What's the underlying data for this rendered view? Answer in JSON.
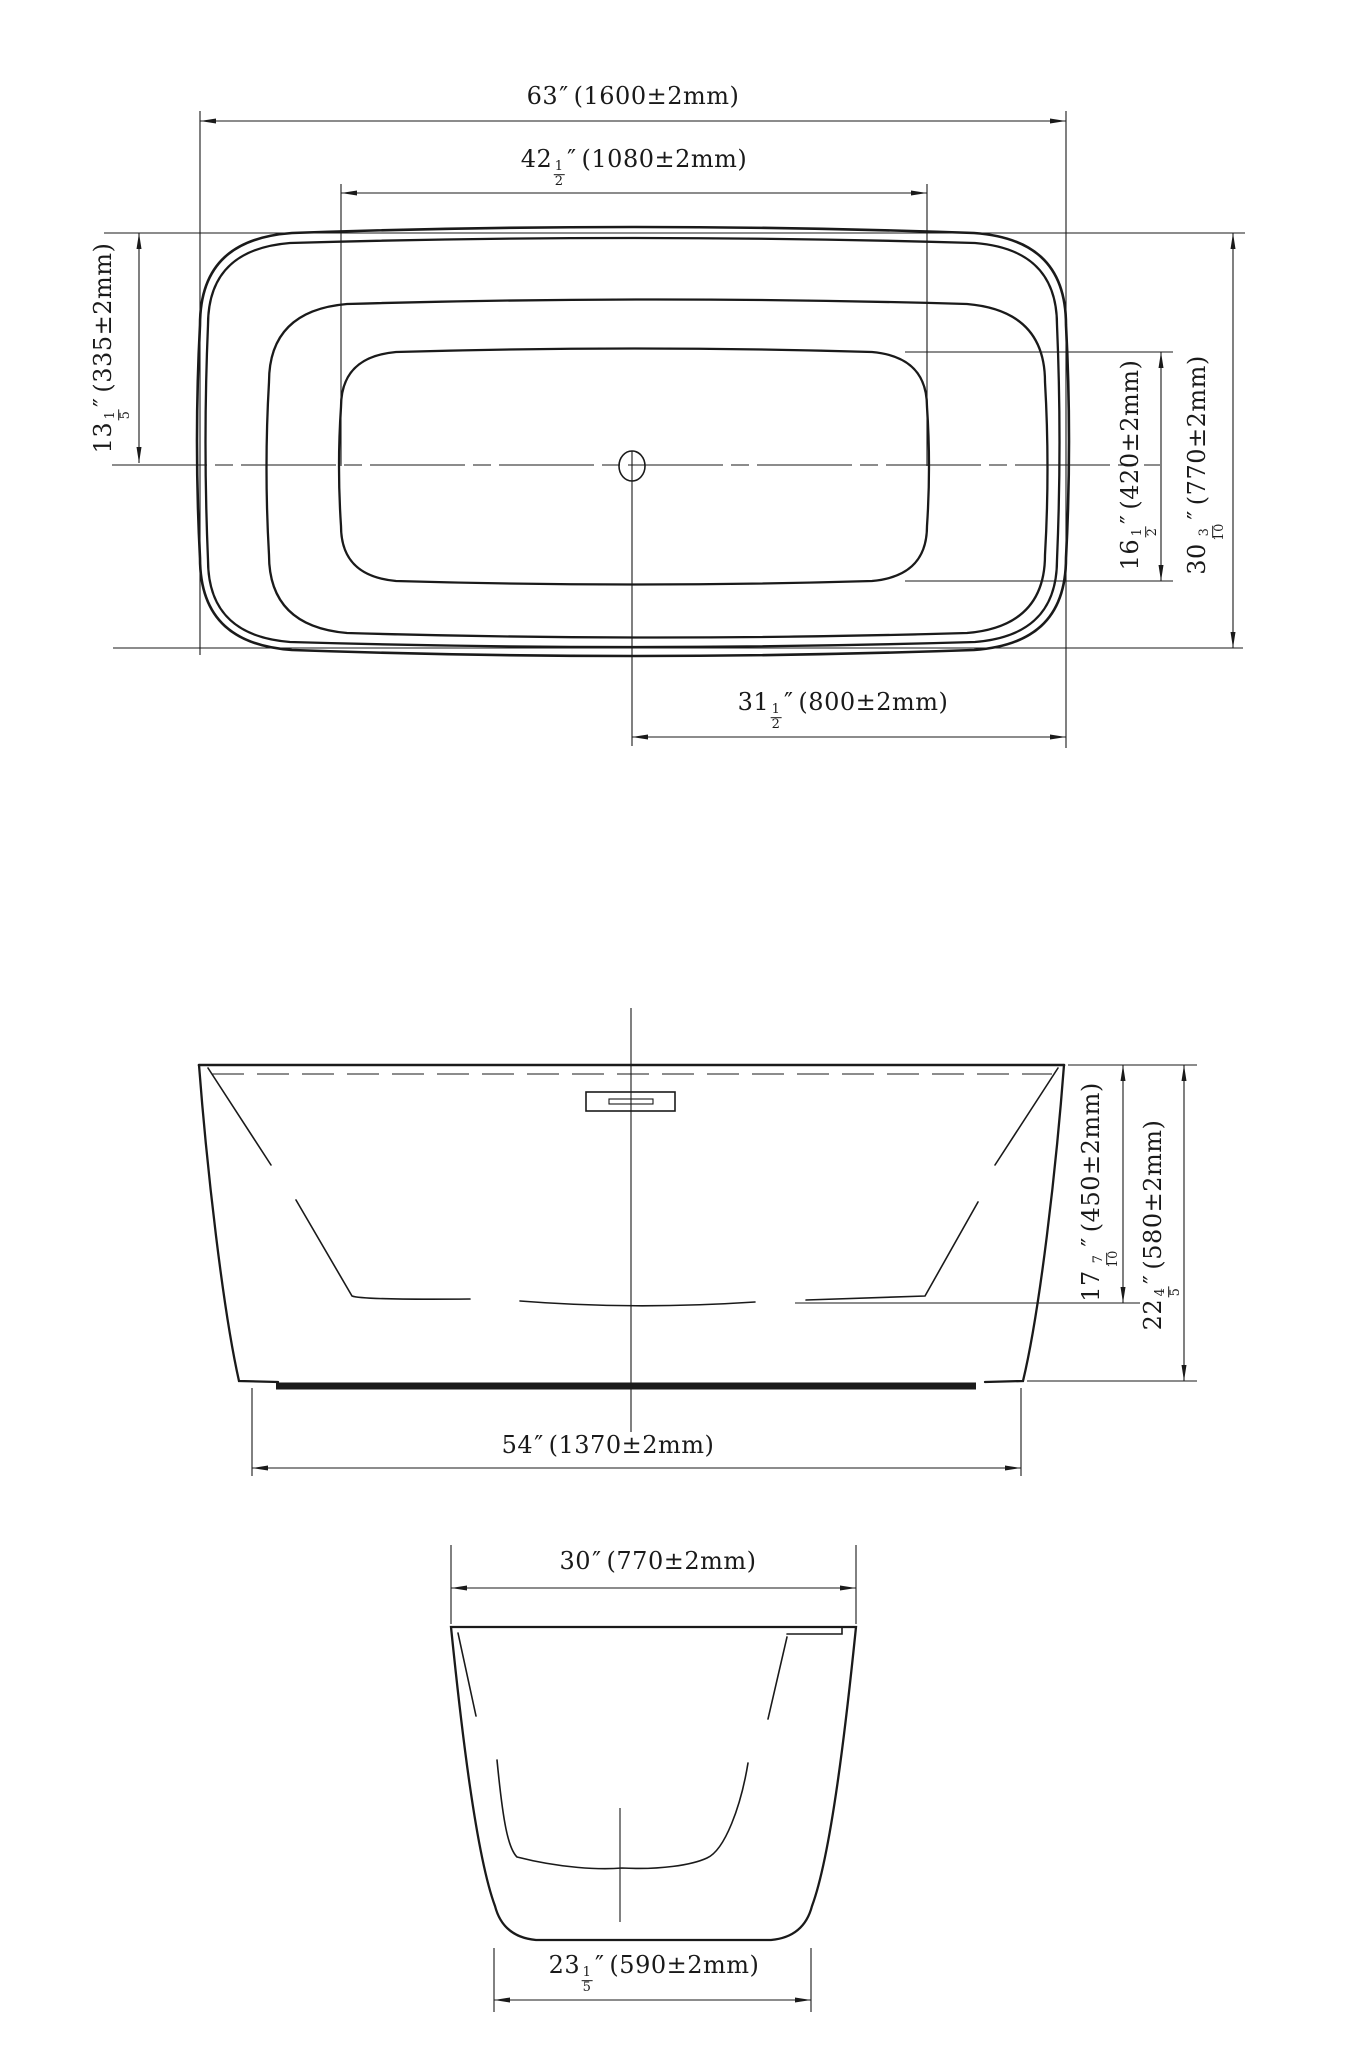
{
  "sheet": {
    "background": "#ffffff",
    "ink": "#1a1a1a"
  },
  "units": {
    "inch_mark": "″"
  },
  "dimensions": {
    "plan_overall_length": {
      "whole": "63",
      "metric": "(1600±2mm)"
    },
    "plan_basin_length": {
      "whole": "42",
      "num": "1",
      "den": "2",
      "metric": "(1080±2mm)"
    },
    "plan_end_offset": {
      "whole": "13",
      "num": "1",
      "den": "5",
      "metric": "(335±2mm)"
    },
    "plan_basin_width": {
      "whole": "16",
      "num": "1",
      "den": "2",
      "metric": "(420±2mm)"
    },
    "plan_overall_width": {
      "whole": "30",
      "num": "3",
      "den": "10",
      "metric": "(770±2mm)"
    },
    "plan_drain_to_end": {
      "whole": "31",
      "num": "1",
      "den": "2",
      "metric": "(800±2mm)"
    },
    "front_rim_to_floor_depth": {
      "whole": "17",
      "num": "7",
      "den": "10",
      "metric": "(450±2mm)"
    },
    "front_overall_height": {
      "whole": "22",
      "num": "4",
      "den": "5",
      "metric": "(580±2mm)"
    },
    "front_base_length": {
      "whole": "54",
      "metric": "(1370±2mm)"
    },
    "end_overall_width": {
      "whole": "30",
      "metric": "(770±2mm)"
    },
    "end_base_width": {
      "whole": "23",
      "num": "1",
      "den": "5",
      "metric": "(590±2mm)"
    }
  }
}
